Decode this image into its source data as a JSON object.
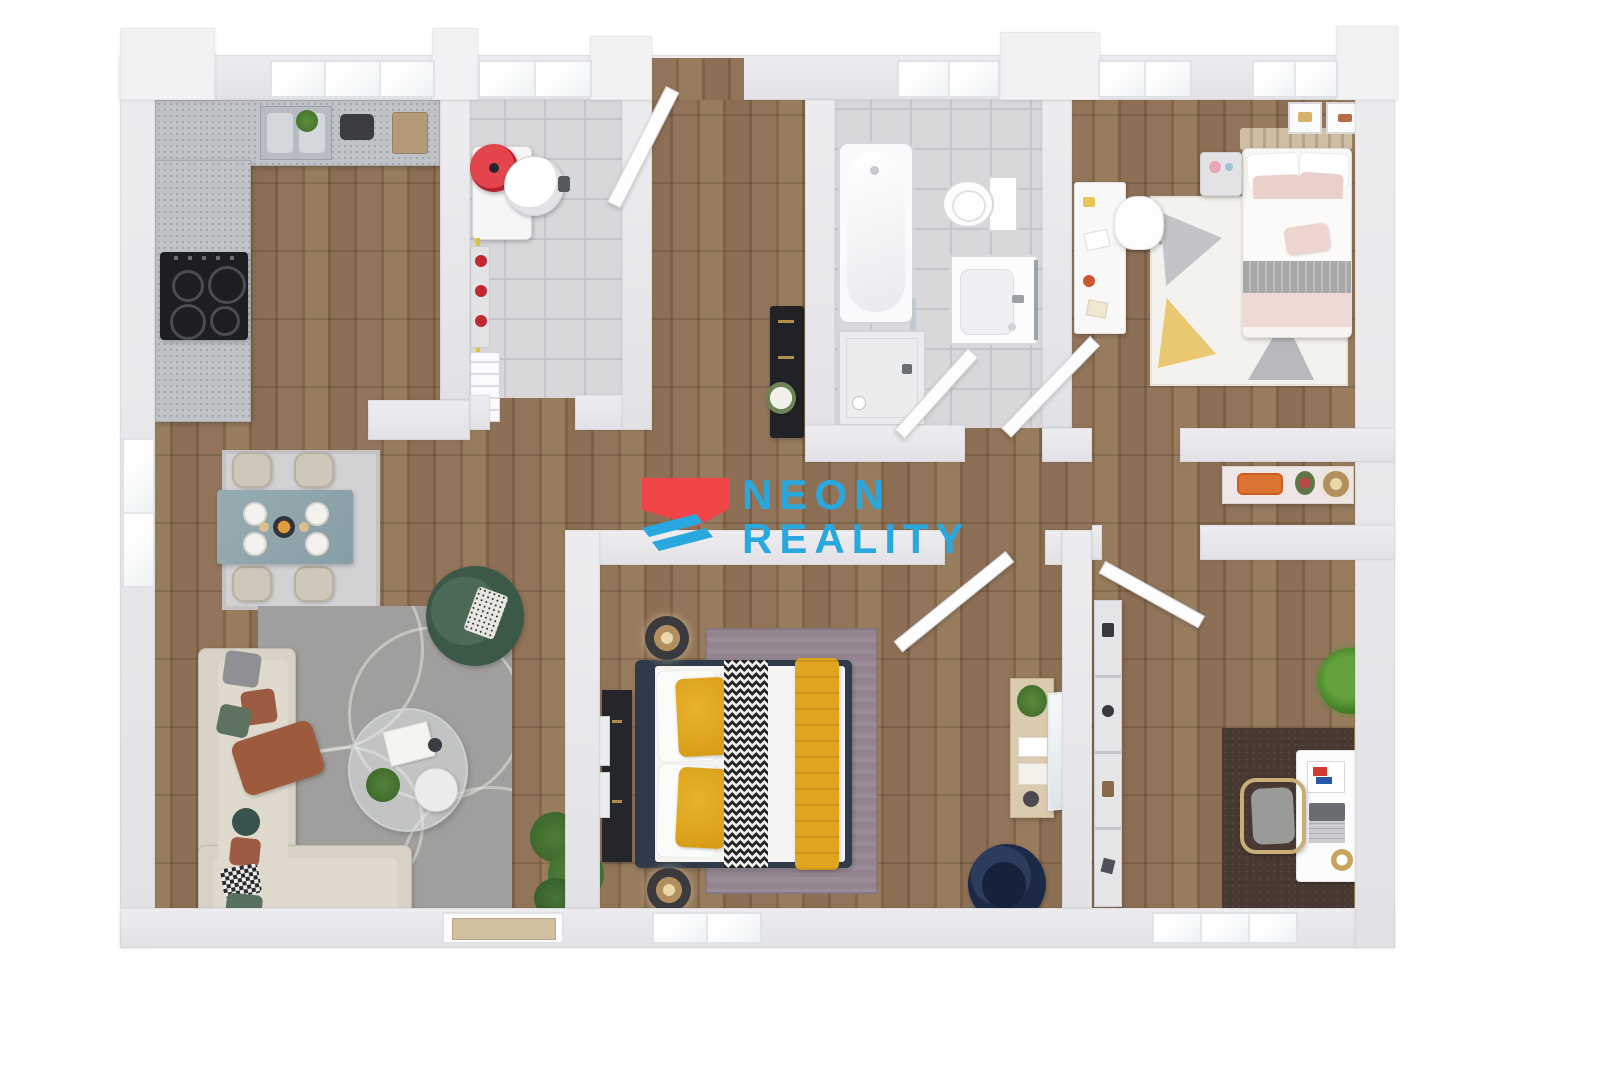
{
  "brand": {
    "line1": "NEON",
    "line2": "REALITY",
    "logo_blue": "#29A8DF",
    "logo_red": "#EF4448"
  },
  "palette": {
    "wall": "#E8E8EB",
    "wood_floor": "#8D7156",
    "tile_floor": "#D8D8DB",
    "accent_yellow": "#E0A41F",
    "accent_navy": "#2F3B4A",
    "accent_green": "#415C4B",
    "rug_gray": "#A09F9D",
    "rug_mauve": "#93848F",
    "rug_office": "#473931",
    "sofa_beige": "#D8D2C6",
    "dining_table": "#91A7AE"
  },
  "scene": {
    "type": "3d-apartment-floor-plan",
    "rooms": [
      {
        "name": "kitchen-living-dining",
        "floor": "wood",
        "items": [
          "kitchen-counter",
          "kitchen-sink",
          "cooktop",
          "dining-table",
          "dining-chairs",
          "dining-rug",
          "sectional-sofa",
          "throw-pillows",
          "coffee-table",
          "side-table",
          "magazines",
          "armchair-green",
          "living-rug",
          "wall-art",
          "floor-plant",
          "left-window"
        ]
      },
      {
        "name": "utility-room",
        "floor": "tile",
        "items": [
          "boiler-red",
          "water-tank",
          "heating-manifold",
          "radiator",
          "yellow-pipe"
        ]
      },
      {
        "name": "hallway",
        "floor": "wood",
        "items": [
          "entrance-door",
          "console-dark",
          "flower-bouquet",
          "sideboard",
          "decor-tray",
          "vase-flowers",
          "table-lamp"
        ]
      },
      {
        "name": "bathroom",
        "floor": "tile",
        "items": [
          "bathtub",
          "shower",
          "glass-panel",
          "toilet",
          "vanity-sink",
          "towel-rail",
          "bathroom-door"
        ]
      },
      {
        "name": "kids-bedroom",
        "floor": "wood",
        "items": [
          "single-bed",
          "headboard",
          "nightstand",
          "kids-desk",
          "desk-chair",
          "geometric-rug",
          "wall-frames",
          "kids-door"
        ]
      },
      {
        "name": "master-bedroom",
        "floor": "wood",
        "items": [
          "double-bed",
          "yellow-pillows",
          "chevron-runner",
          "yellow-blanket",
          "nightstand-lamps",
          "media-console",
          "leaning-frames",
          "wood-dresser",
          "leaning-mirror",
          "navy-armchair",
          "mauve-rug",
          "bedroom-door",
          "bottom-window"
        ]
      },
      {
        "name": "home-office",
        "floor": "wood",
        "items": [
          "office-desk",
          "laptop",
          "office-chair",
          "bookshelf",
          "office-rug",
          "potted-plant",
          "wall-frames",
          "office-door",
          "bottom-window"
        ]
      }
    ]
  }
}
